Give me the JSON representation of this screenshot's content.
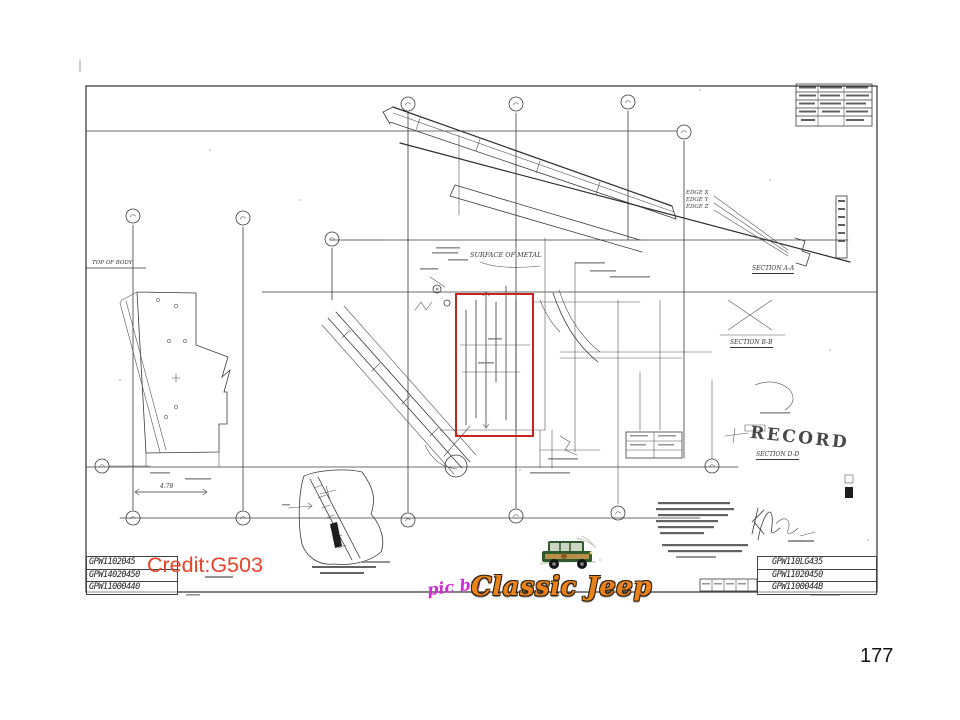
{
  "slide": {
    "page_number": "177",
    "background": "#ffffff"
  },
  "overlay": {
    "credit_text": "Credit:G503",
    "credit_color": "#e8432a",
    "pic_by_text": "pic by",
    "pic_by_color": "#cd30d2",
    "brand_text": "Classic Jeep",
    "brand_color": "#e8831c",
    "highlight_color": "#c5271f"
  },
  "drawing": {
    "record_stamp": "RECORD",
    "labels": {
      "surface": "SURFACE OF METAL",
      "top_of_body": "TOP OF BODY",
      "edge_x": "EDGE X",
      "edge_y": "EDGE Y",
      "edge_z": "EDGE Z",
      "section_aa": "SECTION A-A",
      "section_bb": "SECTION B-B",
      "section_dd": "SECTION D-D",
      "dim_478": "4.78"
    },
    "title_block_left": [
      "GPW1102045",
      "GPW14020450",
      "GPW11000440"
    ],
    "title_block_right": [
      "GPW110LG435",
      "GPW11020450",
      "GPW1100044B"
    ]
  },
  "icons": {
    "jeep_thumbnail": "classic-jeep-wagon-illustration",
    "balloon_callout": "circled-number-callout"
  }
}
